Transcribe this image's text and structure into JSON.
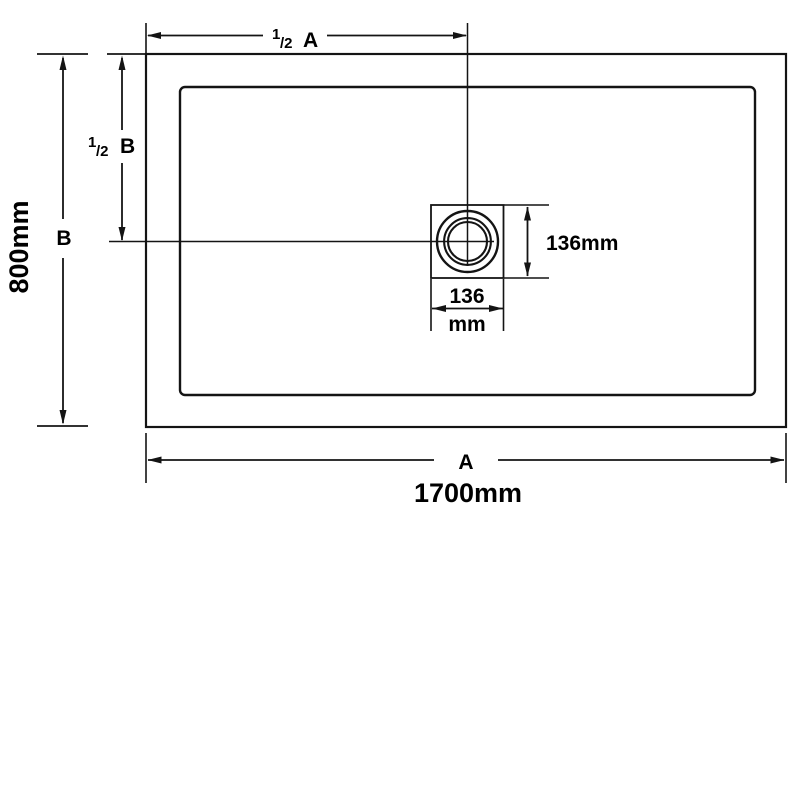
{
  "diagram": {
    "background_color": "#ffffff",
    "line_color": "#141414",
    "text_color": "#000000",
    "dimensions": {
      "half_a": {
        "num": "1",
        "den": "/2",
        "letter": "A"
      },
      "half_b": {
        "num": "1",
        "den": "/2",
        "letter": "B"
      },
      "b_letter": "B",
      "b_value": "800mm",
      "a_letter": "A",
      "a_value": "1700mm",
      "drain_height": "136mm",
      "drain_width_num": "136",
      "drain_width_unit": "mm"
    }
  }
}
